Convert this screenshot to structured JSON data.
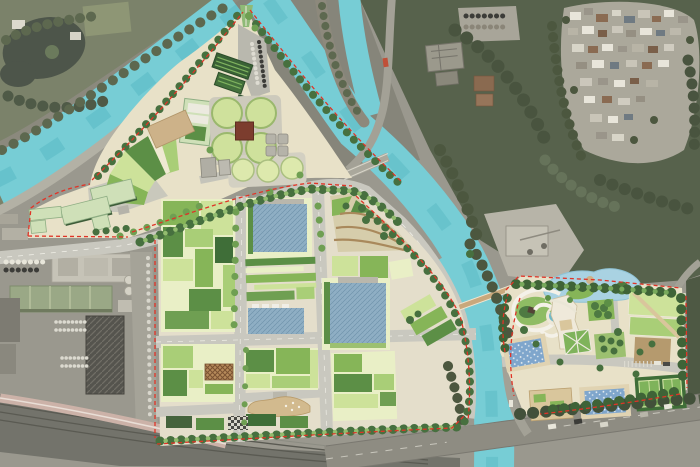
{
  "map": {
    "type": "aerial-masterplan-overlay",
    "features": {
      "canal": "canal-waterway",
      "treatment_plant": "circular-treatment-tanks",
      "central_campus": "agricultural-plot-campus",
      "east_park": "recreation-park",
      "railway": "railway-corridor"
    }
  },
  "palette": {
    "sat_base": "#9a988e",
    "sat_park": "#7b826a",
    "sat_pond": "#4d554a",
    "sat_forest": "#57624c",
    "sat_forest_dark": "#47523d",
    "sat_road": "#a3a196",
    "village_base": "#aba89b",
    "canal": "#77cdd5",
    "canal_deep": "#5fbdc7",
    "ground": "#e8e1c8",
    "ground2": "#e4decb",
    "road": "#c9c8bf",
    "road_line": "#efeee6",
    "boundary": "#e03427",
    "tree_dark": "#47703f",
    "tree_mid": "#6f9f52",
    "tree_light": "#93bd6f",
    "plot_pale": "#e9efc6",
    "plot_light": "#cde29a",
    "plot_mid": "#a9ce77",
    "plot_green": "#86b558",
    "plot_deep": "#5c8f46",
    "plot_dark": "#3f6e38",
    "roof_blue": "#8fafc4",
    "roof_blue_line": "#7093ab",
    "roof_pale": "#cfe0b8",
    "roof_shed": "#3a6136",
    "roof_tan": "#d9c69c",
    "roof_white": "#efe9da",
    "tank": "#cfe19c",
    "tank_rim": "#9ab86d",
    "hub": "#7c3d2e",
    "lagoon": "#a9d2e2",
    "pool": "#7fa6cc",
    "pool_teal": "#6fb9c9",
    "deck": "#e0d3b2",
    "terrace": "#a9895c",
    "plaza_brown": "#b59a6e",
    "court": "#3f6e38",
    "court_in": "#7fb35b",
    "rail": "#73736b",
    "rail_line": "#5a5a52",
    "viaduct": "#ccb2a8",
    "hatch_dark": "#55544e",
    "lattice": "#b58a5a"
  }
}
